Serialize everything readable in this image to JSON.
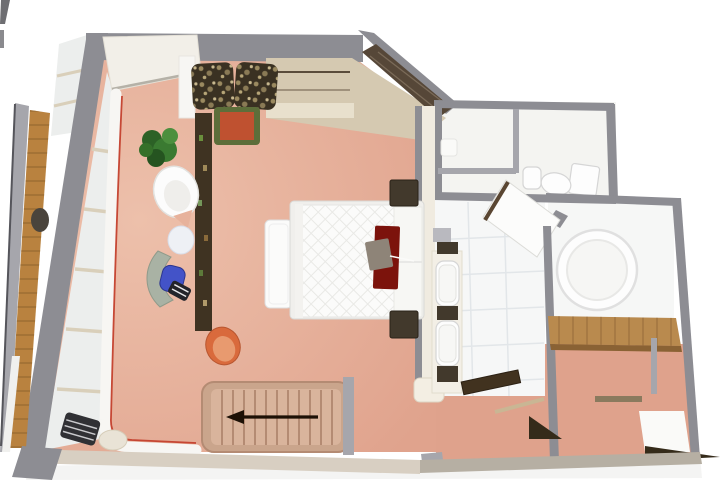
{
  "scene": {
    "type": "3d-floor-plan-render",
    "view": "bird's-eye 3D render of an apartment floor",
    "visible_features": [
      "bedroom with double bed",
      "wardrobe along angled wall",
      "bathroom with round tub and two basins",
      "separate WC with toilet",
      "entry hall with open door",
      "balcony with wood deck and railing",
      "staircase with direction arrow",
      "desk with blue chair",
      "egg chair",
      "potted plants"
    ]
  },
  "icons": {
    "stairs_direction_arrow": "←"
  },
  "colors": {
    "background": "#ffffff",
    "shadow": "#ebebe9",
    "floor": "#e0a38d",
    "floor_light": "#edc0ab",
    "hallway_floor": "#dfa28c",
    "floor_white": "#f4f4f1",
    "tile_white": "#f6f7f7",
    "grout": "#e2e6e9",
    "wall": "#8d8d93",
    "wall_light": "#a6a6ac",
    "wall_cream": "#f0ebe0",
    "wall_face": "#d8cfc2",
    "wall_tan": "#b6afa3",
    "wardrobe": "#d5c9b1",
    "wardrobe_light": "#e8e0cd",
    "mirror": "#564738",
    "wood": "#b9823f",
    "wood_dark": "#8a6234",
    "wood_shelf": "#b98a4e",
    "dark_wood": "#42392c",
    "sill_white": "#f7f6f3",
    "trim_red": "#c23b28",
    "frame_beige": "#d9cfba",
    "canopy": "#f2efe8",
    "glazing": "#eceeed",
    "stairs": "#caa58c",
    "stairs_inner": "#d9b49c",
    "stairs_line": "#b48b73",
    "arrow": "#1d1106",
    "bed": "#fbfbfa",
    "bed_frame": "#f0efec",
    "runner": "#7c130c",
    "tray": "#8e8478",
    "leopard": "#3a3122",
    "plant": "#3a7a31",
    "plant_dark": "#255420",
    "pot": "#bf5130",
    "pot_rim": "#5d6e3a",
    "chair_blue": "#4353c8",
    "stripe_dark": "#23242a",
    "chair_orange": "#d96a3c",
    "chair_white": "#fcfcfc",
    "fixture_white": "#fdfdfd",
    "fixture_line": "#d5d5d5",
    "tub_rim": "#e0e0e0",
    "divider": "#3f3322",
    "lounge_dark": "#303034",
    "pouf": "#e9e3d6",
    "railing_edge": "#55555b",
    "door_edge_brown": "#5a4632",
    "landing_white": "#fafaf8",
    "stair_dark": "#352b1a"
  }
}
